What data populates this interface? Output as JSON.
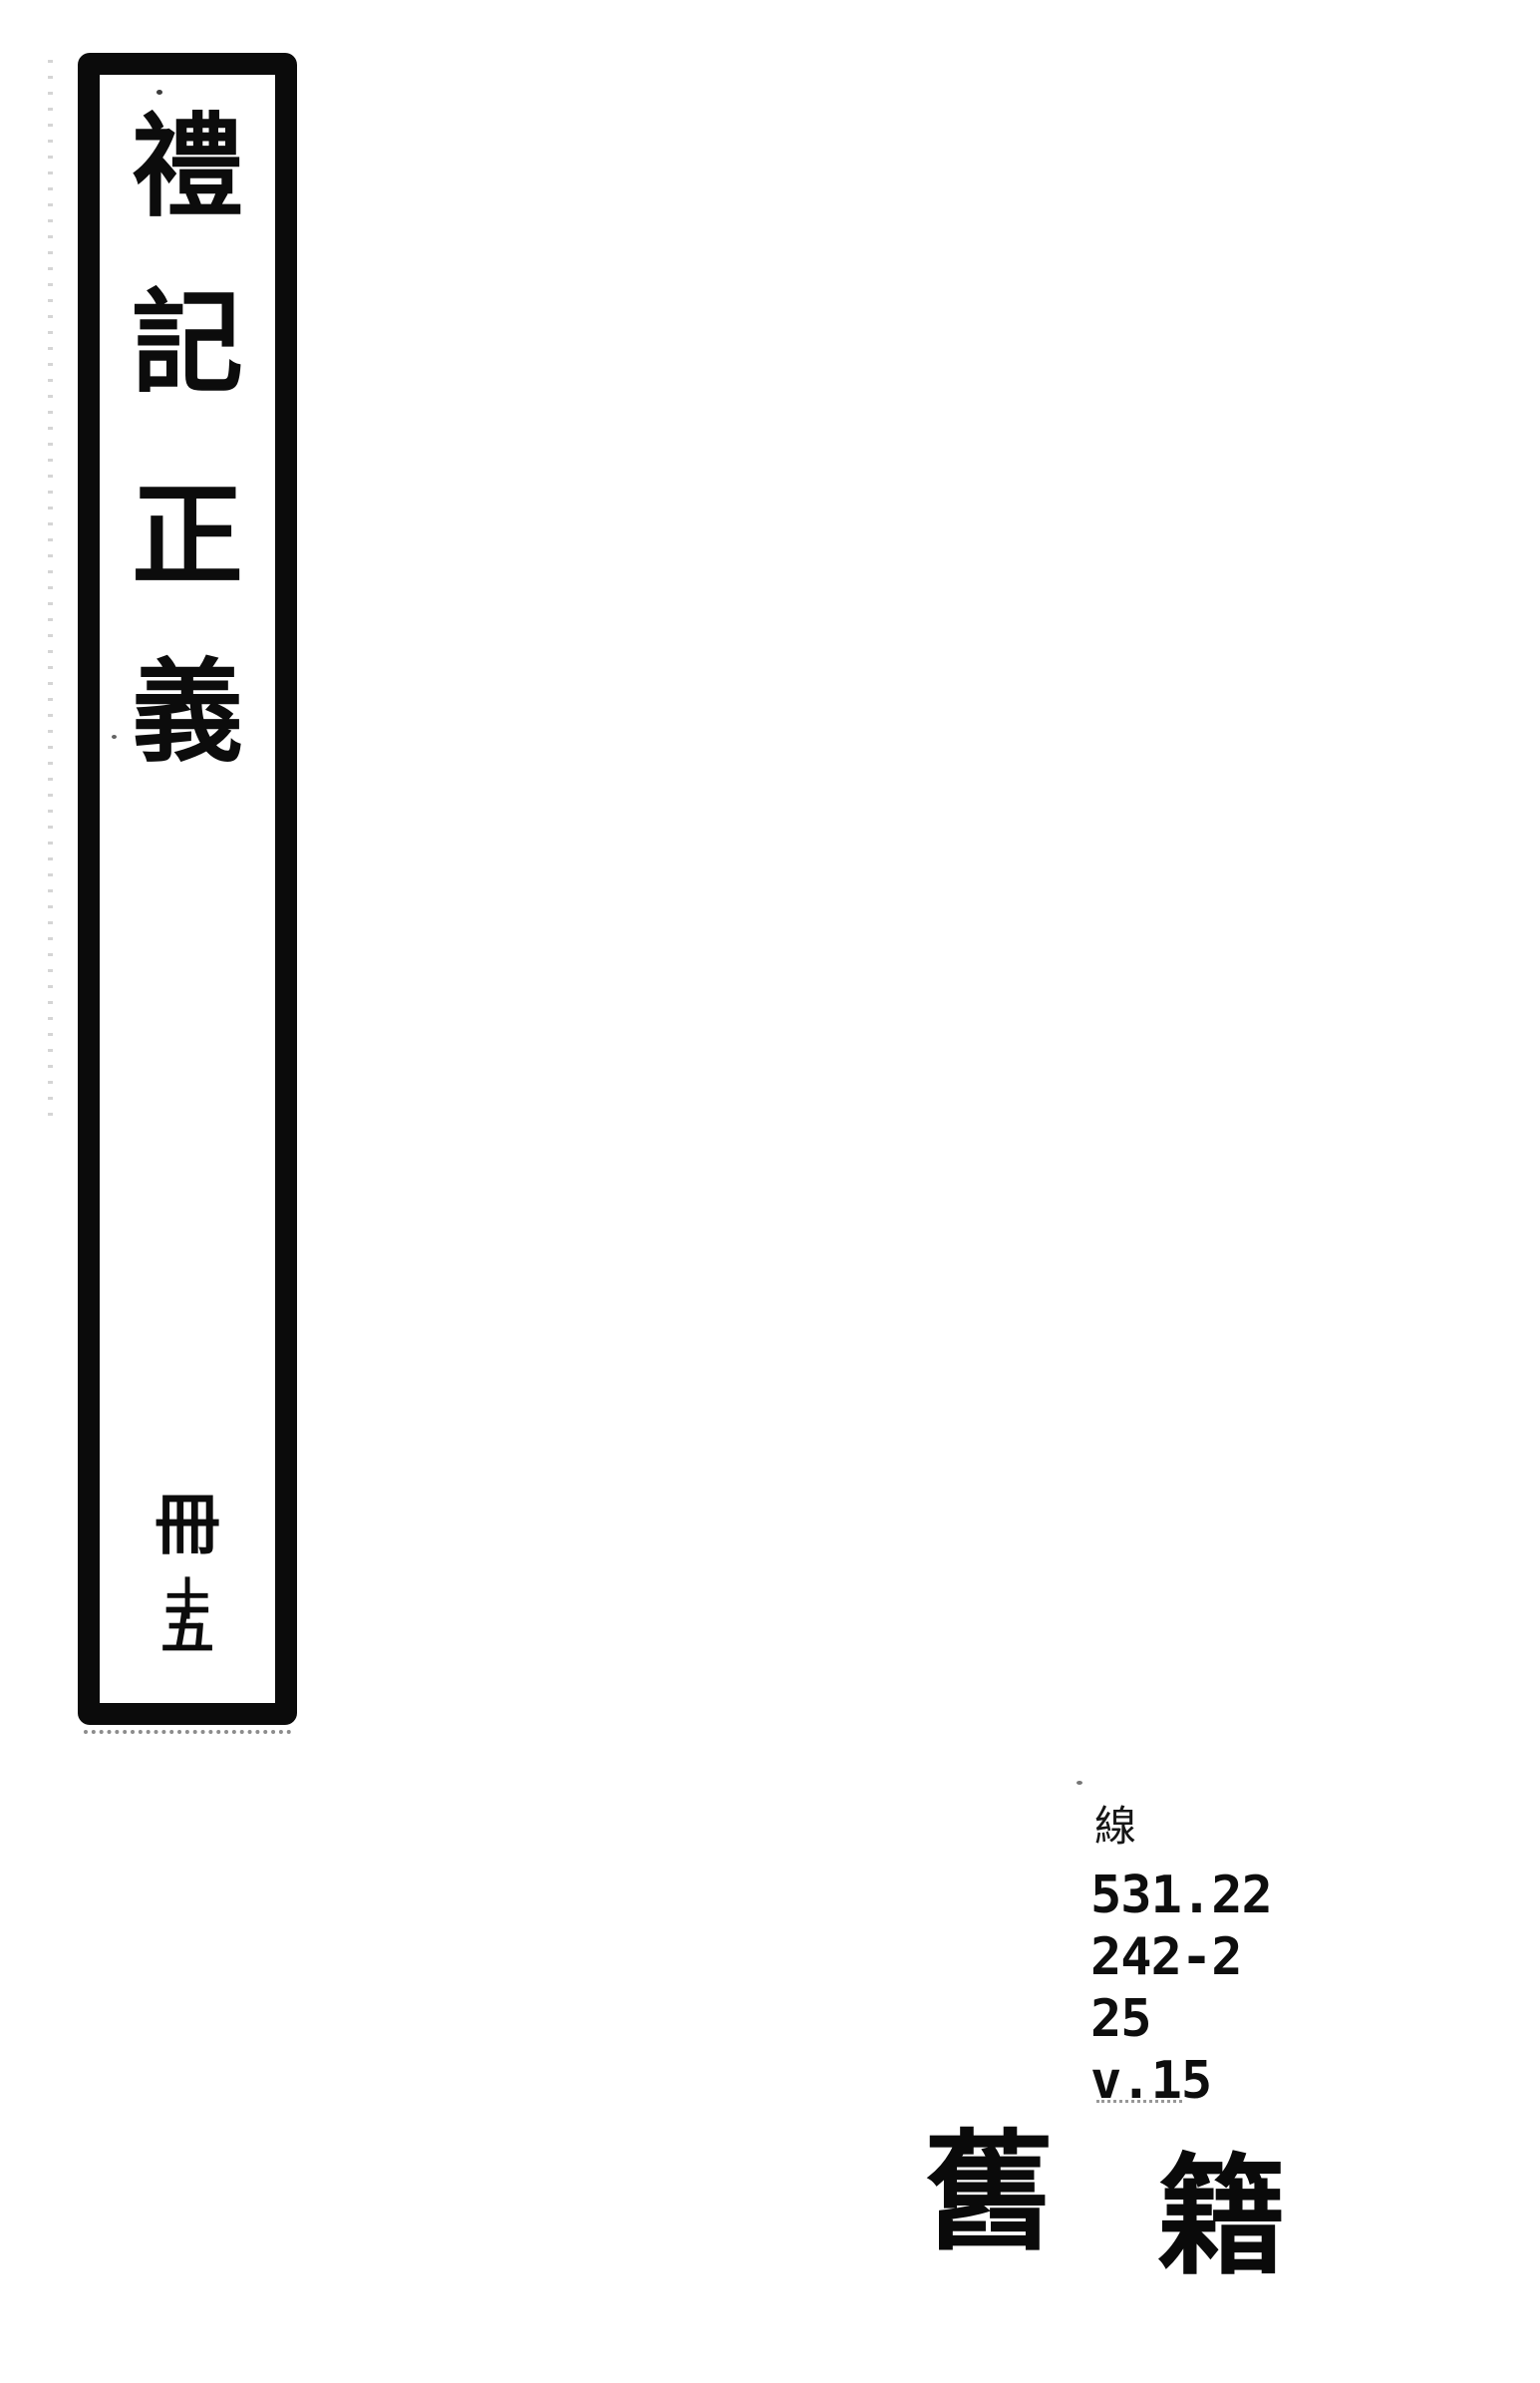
{
  "spine": {
    "title_chars": [
      "禮",
      "記",
      "正",
      "義"
    ],
    "volume": {
      "counter": "冊",
      "number_top": "十",
      "number_bottom": "五"
    }
  },
  "call_number": {
    "category": "線",
    "lines": [
      "531.22",
      "242-2",
      "25",
      "v.15"
    ]
  },
  "stamp": {
    "chars": [
      "舊",
      "籍"
    ]
  },
  "colors": {
    "ink": "#0b0b0b",
    "paper": "#ffffff"
  }
}
